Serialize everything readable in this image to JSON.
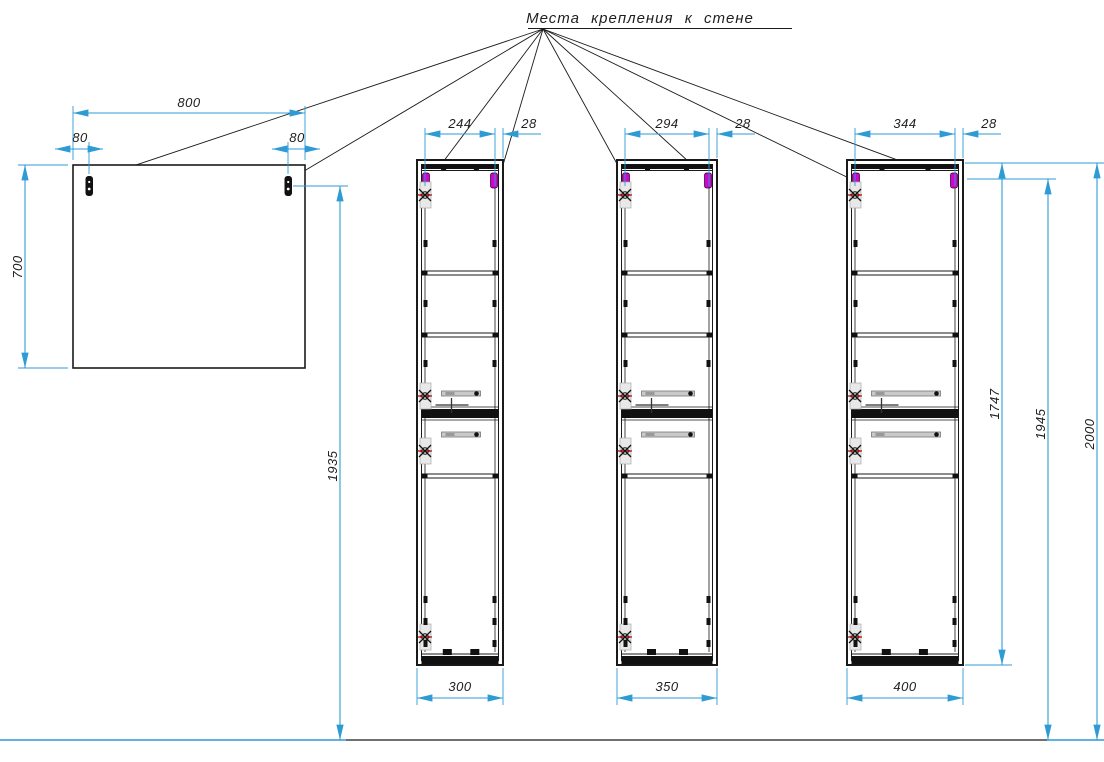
{
  "title": {
    "text": "Места крепления к стене"
  },
  "mirror": {
    "width": "800",
    "left_offset": "80",
    "right_offset": "80",
    "height": "700",
    "mount_to_floor": "1935"
  },
  "cabinets": [
    {
      "mount_span": "244",
      "edge_offset": "28",
      "width": "300"
    },
    {
      "mount_span": "294",
      "edge_offset": "28",
      "width": "350"
    },
    {
      "mount_span": "344",
      "edge_offset": "28",
      "width": "400"
    }
  ],
  "heights": {
    "cabinet": "1747",
    "mount": "1945",
    "total": "2000"
  },
  "colors": {
    "dimension": "#2E9BD5",
    "drawing": "#1a1a1a",
    "bracket": "#D400D4",
    "hinge": "#9B1C1C"
  }
}
